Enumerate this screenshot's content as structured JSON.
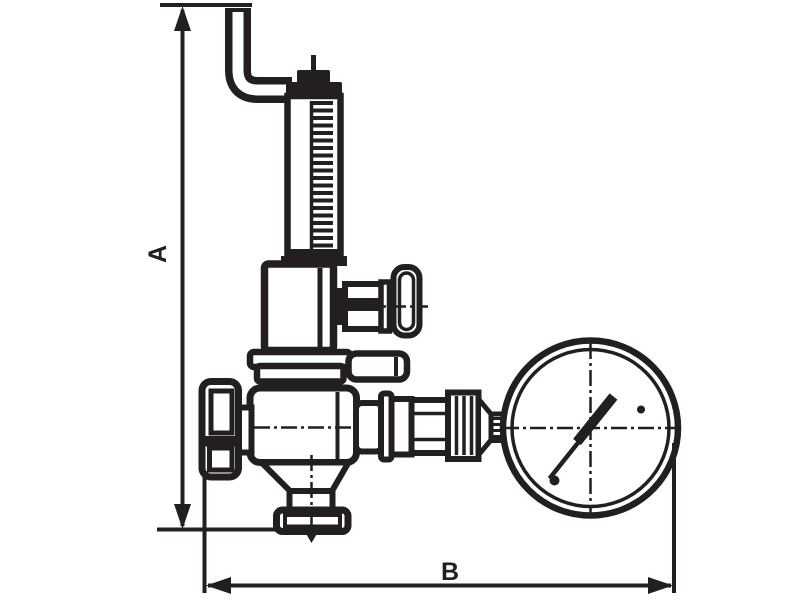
{
  "labels": {
    "dim_a": "A",
    "dim_b": "B"
  },
  "colors": {
    "ink": "#231f20",
    "background": "#ffffff"
  }
}
